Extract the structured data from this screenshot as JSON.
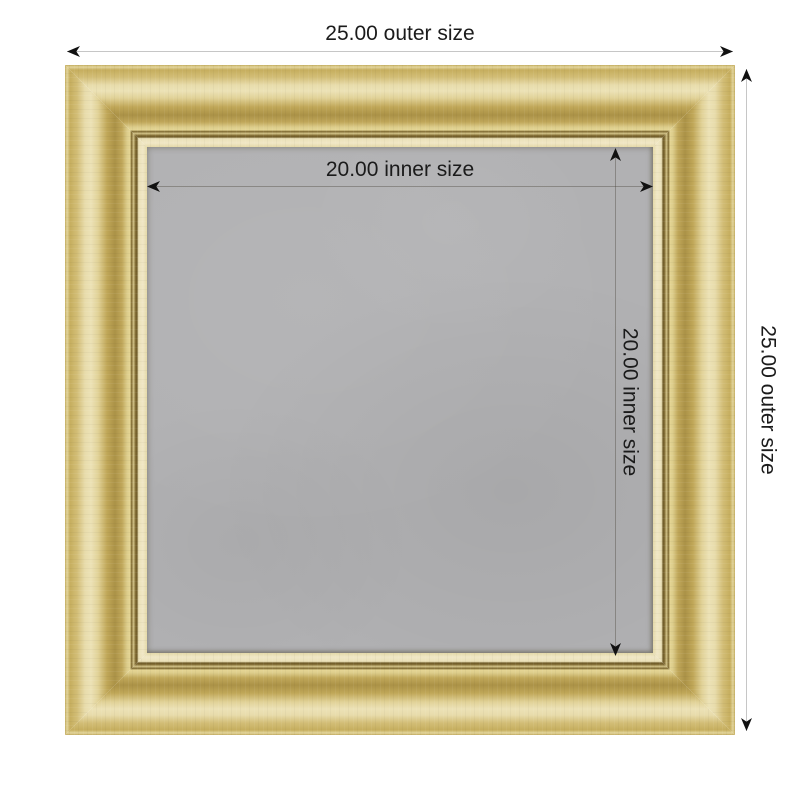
{
  "theme": {
    "page_bg": "#ffffff",
    "gold_light": "#ece2b6",
    "gold_mid": "#c9b164",
    "gold_dark": "#ab9247",
    "lip_cream": "#f0e7c6",
    "board_gray": "#b1b1b3",
    "dim_line_outer": "#c6c6c6",
    "dim_line_inner": "rgba(70,65,55,0.38)",
    "arrow_black": "#111111",
    "label_text": "#1b1b1b"
  },
  "product": {
    "type": "gold picture frame with gray board, dimension diagram",
    "frame_finish": "gold",
    "board_finish": "gray"
  },
  "dimensions": {
    "outer_width": {
      "label": "25.00 outer size",
      "value": "25.00"
    },
    "outer_height": {
      "label": "25.00 outer size",
      "value": "25.00"
    },
    "inner_width": {
      "label": "20.00 inner size",
      "value": "20.00"
    },
    "inner_height": {
      "label": "20.00 inner size",
      "value": "20.00"
    }
  }
}
